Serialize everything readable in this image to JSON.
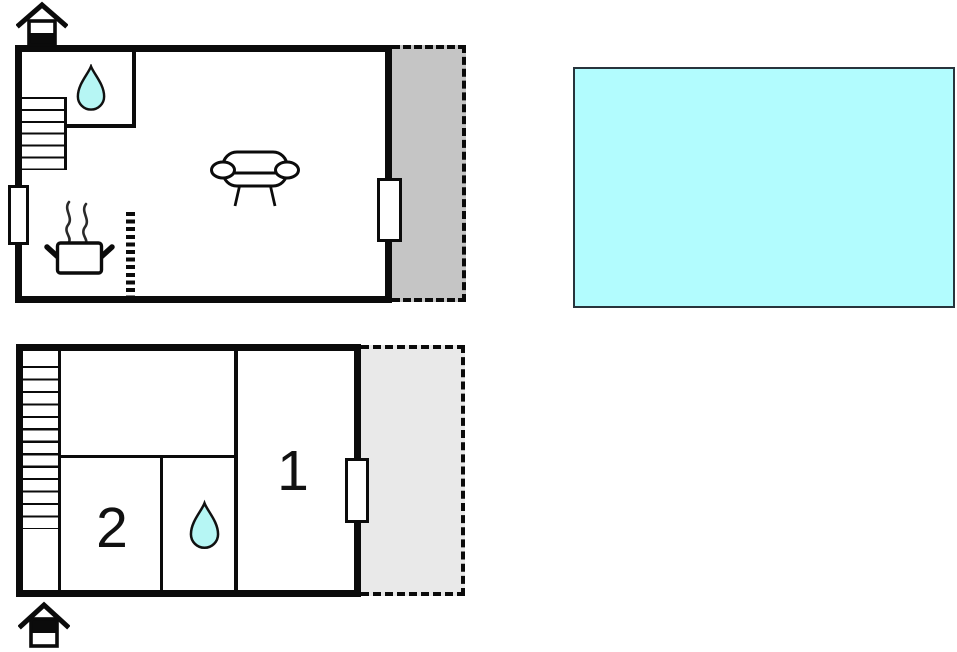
{
  "colors": {
    "background": "#ffffff",
    "wall": "#0b0b0b",
    "terrace_fill": "#c5c5c5",
    "balcony_fill": "#e9e9e9",
    "pool_fill": "#b2fcfe",
    "pool_border": "#28343c",
    "water_drop_fill": "#b6f6f4"
  },
  "ground_floor": {
    "features": {
      "entrance": "house-entrance-icon",
      "stairs": "staircase",
      "bathroom": "water-drop-icon",
      "living_area": "sofa-icon",
      "kitchen": "cooking-pot-icon",
      "kitchen_divider": "dashed-partial-wall",
      "terrace": "terrace-area",
      "window_count": 2
    }
  },
  "upper_floor": {
    "rooms": [
      {
        "label": "1"
      },
      {
        "label": "2"
      }
    ],
    "features": {
      "stairs": "staircase",
      "bathroom": "water-drop-icon",
      "balcony": "balcony-area",
      "entrance": "house-entrance-icon",
      "window_count": 1
    }
  },
  "pool": {
    "name": "swimming-pool"
  }
}
